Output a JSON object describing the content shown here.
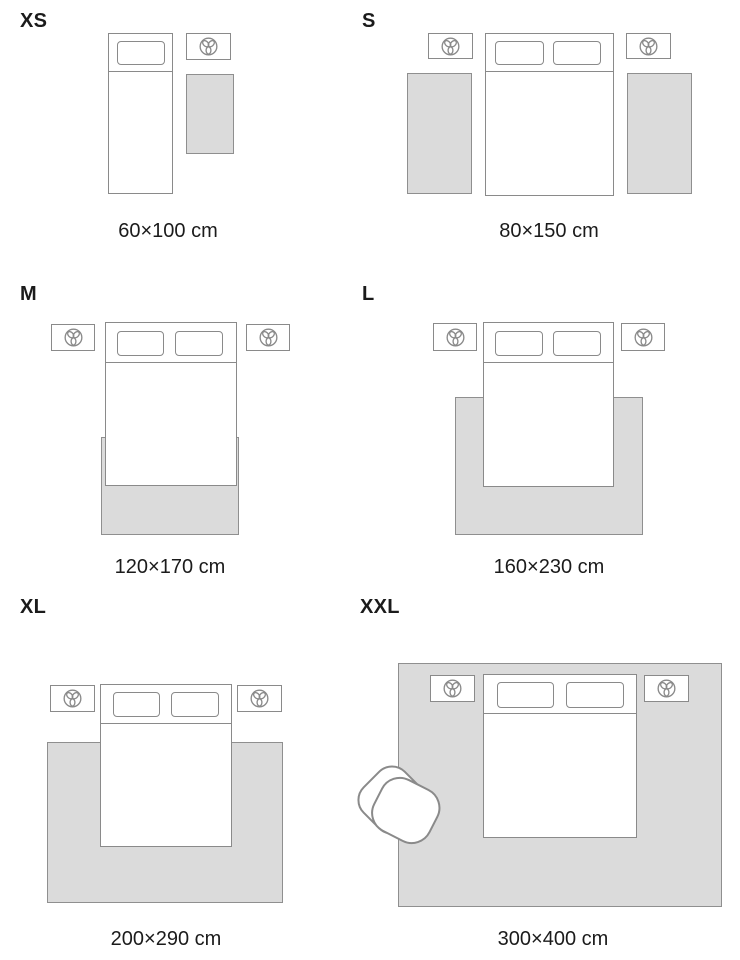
{
  "colors": {
    "text": "#1b1b1b",
    "outline": "#8a8a8a",
    "rug_fill": "#dbdbdb",
    "rug_border": "#8f8f8f",
    "furniture_fill": "#ffffff"
  },
  "icons": {
    "nightstand": "three-petal-plant-icon",
    "armchair": "armchair-top-view-icon"
  },
  "sizes": [
    {
      "label": "XS",
      "caption": "60×100 cm"
    },
    {
      "label": "S",
      "caption": "80×150 cm"
    },
    {
      "label": "M",
      "caption": "120×170 cm"
    },
    {
      "label": "L",
      "caption": "160×230 cm"
    },
    {
      "label": "XL",
      "caption": "200×290 cm"
    },
    {
      "label": "XXL",
      "caption": "300×400 cm"
    }
  ]
}
